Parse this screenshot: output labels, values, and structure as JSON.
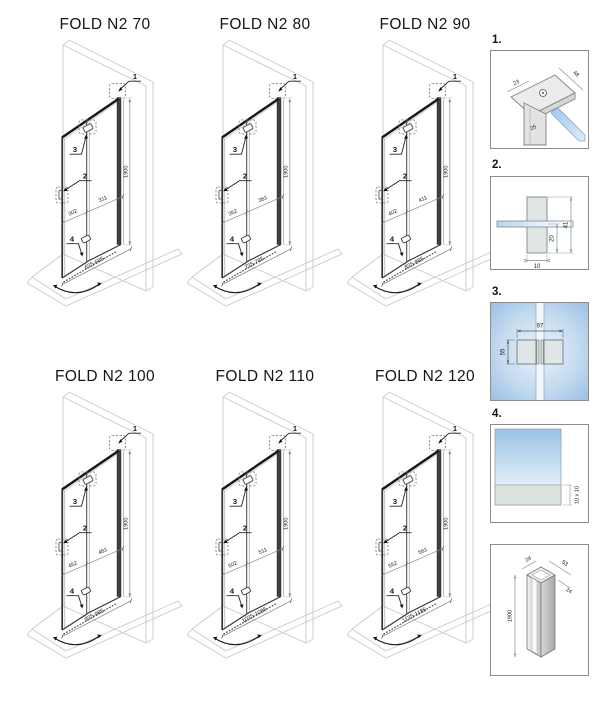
{
  "diagrams": [
    {
      "title": "FOLD N2 70",
      "left_panel": "302",
      "right_panel": "311",
      "width_range": "675-685",
      "height": "1900"
    },
    {
      "title": "FOLD N2 80",
      "left_panel": "352",
      "right_panel": "361",
      "width_range": "775-785",
      "height": "1900"
    },
    {
      "title": "FOLD N2 90",
      "left_panel": "402",
      "right_panel": "411",
      "width_range": "875-885",
      "height": "1900"
    },
    {
      "title": "FOLD N2 100",
      "left_panel": "452",
      "right_panel": "461",
      "width_range": "975-985",
      "height": "1900"
    },
    {
      "title": "FOLD N2 110",
      "left_panel": "502",
      "right_panel": "511",
      "width_range": "1075-1085",
      "height": "1900"
    },
    {
      "title": "FOLD N2 120",
      "left_panel": "552",
      "right_panel": "561",
      "width_range": "1175-1185",
      "height": "1900"
    }
  ],
  "callouts": {
    "c1": "1",
    "c2": "2",
    "c3": "3",
    "c4": "4"
  },
  "details": {
    "d1": {
      "label": "1.",
      "dim_a": "23",
      "dim_b": "48",
      "dim_c": "25"
    },
    "d2": {
      "label": "2.",
      "dim_width": "10",
      "dim_lower": "20",
      "dim_total": "41"
    },
    "d3": {
      "label": "3.",
      "dim_width": "97",
      "dim_height": "55"
    },
    "d4": {
      "label": "4.",
      "dim_seal": "10 x 10"
    },
    "d5": {
      "dim_top": "24",
      "dim_depth": "53",
      "dim_side": "24",
      "dim_height": "1900"
    }
  },
  "colors": {
    "glass_blue": "#b9d7f1",
    "construction_gray": "#c9c9c9",
    "profile_dark": "#3f3f3f",
    "dimension_gray": "#7d8f98"
  }
}
